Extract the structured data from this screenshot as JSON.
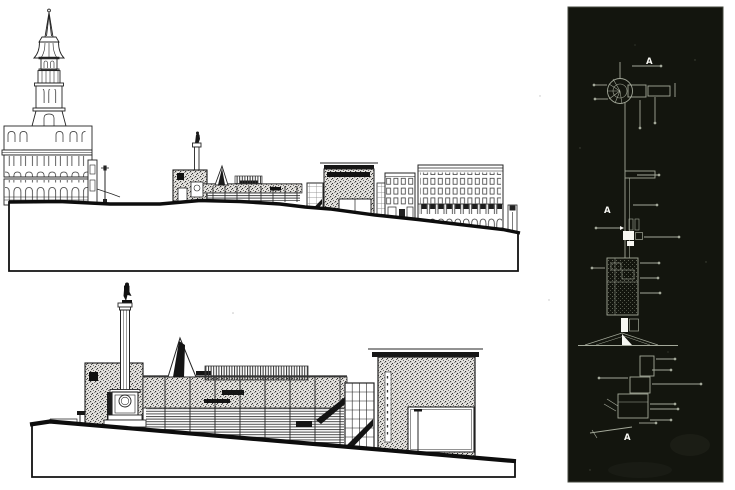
{
  "palette": {
    "paper": "#ffffff",
    "ink": "#161616",
    "stone_hatch": "#3c3c3c",
    "panel_background": "#13150e",
    "panel_linework": "#a3a899",
    "panel_highlight": "#f7f7f2"
  },
  "site_plan": {
    "section_markers": {
      "top": "A",
      "middle": "A",
      "bottom": "A"
    }
  }
}
